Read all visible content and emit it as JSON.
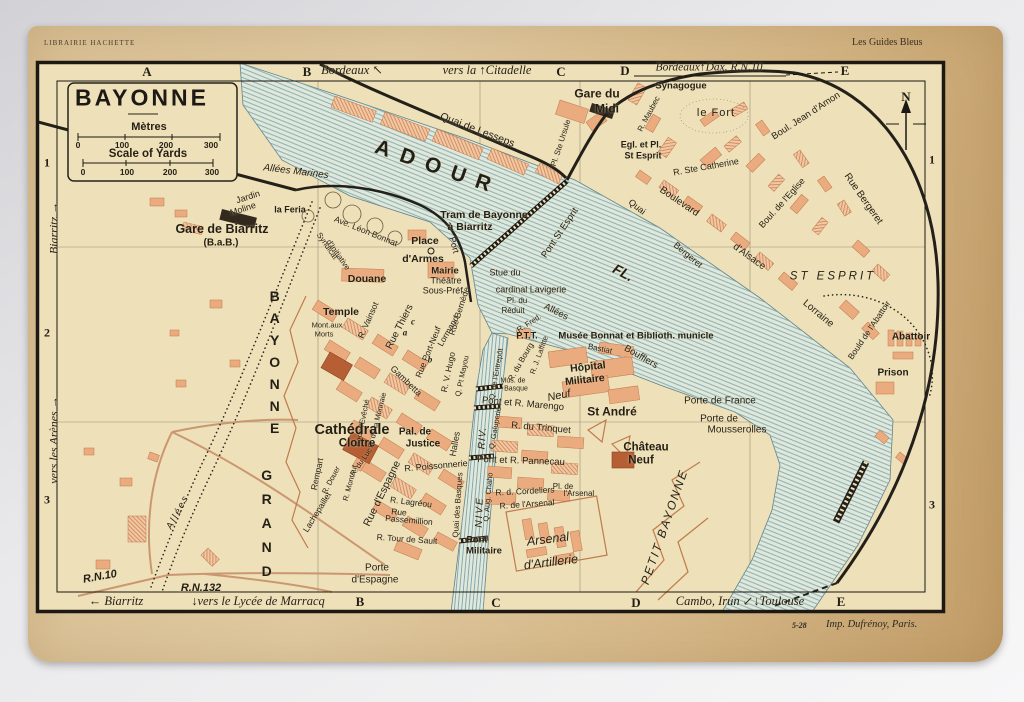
{
  "colors": {
    "paper": "#d9bf93",
    "map_bg": "#eee0b8",
    "ink": "#1c1914",
    "block": "#eaab7e",
    "block_dark": "#b65f35",
    "building_black": "#33291e",
    "river_fill": "#dfe8da",
    "river_line": "#82a8ae",
    "road": "#c8906a"
  },
  "header": {
    "left": "LIBRAIRIE HACHETTE",
    "right": "Les Guides Bleus"
  },
  "imprint": {
    "code": "5-28",
    "text": "Imp. Dufrénoy, Paris."
  },
  "title_block": {
    "title": "BAYONNE",
    "metres": "Mètres",
    "yards": "Scale of Yards"
  },
  "scale": {
    "ticks": [
      {
        "t": "0",
        "x": 78,
        "y": 145,
        "s": 8.5,
        "c": "b"
      },
      {
        "t": "100",
        "x": 122,
        "y": 145,
        "s": 8.5,
        "c": "b"
      },
      {
        "t": "200",
        "x": 166,
        "y": 145,
        "s": 8.5,
        "c": "b"
      },
      {
        "t": "300",
        "x": 211,
        "y": 145,
        "s": 8.5,
        "c": "b"
      },
      {
        "t": "0",
        "x": 83,
        "y": 172,
        "s": 8.5,
        "c": "b"
      },
      {
        "t": "100",
        "x": 127,
        "y": 172,
        "s": 8.5,
        "c": "b"
      },
      {
        "t": "200",
        "x": 170,
        "y": 172,
        "s": 8.5,
        "c": "b"
      },
      {
        "t": "300",
        "x": 212,
        "y": 172,
        "s": 8.5,
        "c": "b"
      }
    ]
  },
  "grid": {
    "letters": [
      {
        "t": "A",
        "x": 147,
        "y": 72,
        "s": 13,
        "c": "serif b"
      },
      {
        "t": "B",
        "x": 307,
        "y": 72,
        "s": 13,
        "c": "serif b"
      },
      {
        "t": "C",
        "x": 561,
        "y": 72,
        "s": 13,
        "c": "serif b"
      },
      {
        "t": "D",
        "x": 625,
        "y": 71,
        "s": 13,
        "c": "serif b"
      },
      {
        "t": "E",
        "x": 845,
        "y": 71,
        "s": 13,
        "c": "serif b"
      },
      {
        "t": "B",
        "x": 360,
        "y": 602,
        "s": 13,
        "c": "serif b"
      },
      {
        "t": "C",
        "x": 496,
        "y": 603,
        "s": 13,
        "c": "serif b"
      },
      {
        "t": "D",
        "x": 636,
        "y": 603,
        "s": 13,
        "c": "serif b"
      },
      {
        "t": "E",
        "x": 841,
        "y": 602,
        "s": 13,
        "c": "serif b"
      }
    ],
    "numbers": [
      {
        "t": "1",
        "x": 47,
        "y": 163,
        "s": 12,
        "c": "serif b"
      },
      {
        "t": "2",
        "x": 47,
        "y": 333,
        "s": 12,
        "c": "serif b"
      },
      {
        "t": "3",
        "x": 47,
        "y": 500,
        "s": 12,
        "c": "serif b"
      },
      {
        "t": "1",
        "x": 932,
        "y": 160,
        "s": 12,
        "c": "serif b"
      },
      {
        "t": "3",
        "x": 932,
        "y": 505,
        "s": 12,
        "c": "serif b"
      }
    ]
  },
  "margins": {
    "notes": [
      {
        "t": "Bordeaux ↖",
        "x": 352,
        "y": 71,
        "s": 12.5,
        "c": "serif i"
      },
      {
        "t": "vers la ↑Citadelle",
        "x": 487,
        "y": 71,
        "s": 12.5,
        "c": "serif i"
      },
      {
        "t": "Bordeaux↑Dax. R.N.10",
        "x": 709,
        "y": 68,
        "s": 11.5,
        "c": "serif i"
      },
      {
        "t": "← Biarritz",
        "x": 116,
        "y": 602,
        "s": 12.5,
        "c": "serif i"
      },
      {
        "t": "↓vers le Lycée de Marracq",
        "x": 258,
        "y": 602,
        "s": 12.5,
        "c": "serif i"
      },
      {
        "t": "Cambo, Irun ↙↓Toulouse",
        "x": 740,
        "y": 602,
        "s": 12.5,
        "c": "serif i"
      },
      {
        "t": "Biarritz →",
        "x": 54,
        "y": 228,
        "s": 12,
        "r": -90,
        "c": "serif i"
      },
      {
        "t": "vers les Arènes →",
        "x": 54,
        "y": 440,
        "s": 12,
        "r": -90,
        "c": "serif i"
      }
    ]
  },
  "map": {
    "labels": [
      {
        "t": "N",
        "x": 906,
        "y": 97,
        "s": 13,
        "c": "serif b",
        "n": "compass-north-label"
      },
      {
        "t": "Gare du",
        "x": 597,
        "y": 94,
        "s": 12,
        "c": "b"
      },
      {
        "t": "Midi",
        "x": 607,
        "y": 109,
        "s": 12,
        "c": "b"
      },
      {
        "t": "Synagogue",
        "x": 681,
        "y": 86,
        "s": 9.5,
        "c": "b"
      },
      {
        "t": "R. Maubec",
        "x": 649,
        "y": 114,
        "s": 8,
        "r": -62
      },
      {
        "t": "le Fort",
        "x": 716,
        "y": 113,
        "s": 11,
        "ls": 1
      },
      {
        "t": "Boul. Jean d'Amon",
        "x": 806,
        "y": 116,
        "s": 9.5,
        "r": -33
      },
      {
        "t": "Rue Bergeret",
        "x": 863,
        "y": 199,
        "s": 10,
        "r": 55
      },
      {
        "t": "R. Ste Catherine",
        "x": 706,
        "y": 167,
        "s": 9,
        "r": -10
      },
      {
        "t": "Boulevard",
        "x": 679,
        "y": 202,
        "s": 10,
        "r": 34
      },
      {
        "t": "d'Alsace",
        "x": 749,
        "y": 257,
        "s": 10,
        "r": 36
      },
      {
        "t": "Lorraine",
        "x": 818,
        "y": 314,
        "s": 10,
        "r": 40
      },
      {
        "t": "Boul. de l'Eglise",
        "x": 782,
        "y": 203,
        "s": 9,
        "r": -48
      },
      {
        "t": "Quai",
        "x": 637,
        "y": 207,
        "s": 9,
        "r": 38
      },
      {
        "t": "Bergeret",
        "x": 688,
        "y": 255,
        "s": 9,
        "r": 40
      },
      {
        "t": "ST ESPRIT",
        "x": 833,
        "y": 277,
        "s": 11.5,
        "c": "i",
        "ls": 3
      },
      {
        "t": "Bould de l'Abattoir",
        "x": 869,
        "y": 330,
        "s": 8.5,
        "r": -56
      },
      {
        "t": "Abattoir",
        "x": 911,
        "y": 337,
        "s": 10,
        "c": "b"
      },
      {
        "t": "Prison",
        "x": 893,
        "y": 373,
        "s": 10,
        "c": "b"
      },
      {
        "t": "Egl. et Pl.",
        "x": 641,
        "y": 145,
        "s": 9,
        "c": "b"
      },
      {
        "t": "St Esprit",
        "x": 643,
        "y": 156,
        "s": 9,
        "c": "b"
      },
      {
        "t": "Quai de Lesseps",
        "x": 477,
        "y": 131,
        "s": 10.5,
        "r": 21
      },
      {
        "t": "Pl. Ste Ursule",
        "x": 561,
        "y": 143,
        "s": 8,
        "r": -72
      },
      {
        "t": "ADOUR",
        "x": 438,
        "y": 168,
        "s": 21,
        "r": 19,
        "c": "b",
        "ls": 11,
        "n": "river-adour-label"
      },
      {
        "t": "FL.",
        "x": 623,
        "y": 273,
        "s": 14,
        "r": 28,
        "c": "b i",
        "n": "river-adour-label"
      },
      {
        "t": "Pont St Esprit",
        "x": 560,
        "y": 233,
        "s": 9.5,
        "r": -56
      },
      {
        "t": "NIVE",
        "x": 480,
        "y": 512,
        "s": 10,
        "r": -88,
        "c": "i",
        "ls": 2,
        "n": "river-nive-label"
      },
      {
        "t": "RIV.",
        "x": 483,
        "y": 438,
        "s": 10,
        "r": -86,
        "c": "i",
        "ls": 1,
        "n": "river-nive-label"
      },
      {
        "t": "Allées Marines",
        "x": 296,
        "y": 172,
        "s": 10,
        "r": 7,
        "c": "i"
      },
      {
        "t": "Jardin",
        "x": 248,
        "y": 197,
        "s": 9,
        "r": -18
      },
      {
        "t": "Moline",
        "x": 243,
        "y": 209,
        "s": 9,
        "r": -18
      },
      {
        "t": "la Feria",
        "x": 290,
        "y": 210,
        "s": 9,
        "c": "b"
      },
      {
        "t": "Gare de Biarritz",
        "x": 222,
        "y": 230,
        "s": 12.5,
        "c": "b"
      },
      {
        "t": "(B.a.B.)",
        "x": 221,
        "y": 243,
        "s": 10,
        "c": "b"
      },
      {
        "t": "Tram de Bayonne",
        "x": 484,
        "y": 216,
        "s": 10.5,
        "c": "b"
      },
      {
        "t": "à Biarritz",
        "x": 470,
        "y": 228,
        "s": 10.5,
        "c": "b"
      },
      {
        "t": "Ave. Léon Bonnat",
        "x": 366,
        "y": 231,
        "s": 8.5,
        "r": 22
      },
      {
        "t": "Syndicat",
        "x": 327,
        "y": 246,
        "s": 8,
        "r": 55
      },
      {
        "t": "d'Initiative",
        "x": 338,
        "y": 255,
        "s": 8,
        "r": 55
      },
      {
        "t": "Port",
        "x": 454,
        "y": 245,
        "s": 9,
        "r": 75
      },
      {
        "t": "Place",
        "x": 425,
        "y": 242,
        "s": 10.5,
        "c": "b"
      },
      {
        "t": "d'Armes",
        "x": 423,
        "y": 260,
        "s": 10.5,
        "c": "b"
      },
      {
        "t": "Mairie",
        "x": 445,
        "y": 271,
        "s": 9.5,
        "c": "b"
      },
      {
        "t": "Théâtre",
        "x": 446,
        "y": 281,
        "s": 9
      },
      {
        "t": "Sous-Préf.",
        "x": 444,
        "y": 291,
        "s": 9
      },
      {
        "t": "Douane",
        "x": 367,
        "y": 280,
        "s": 10.5,
        "c": "b"
      },
      {
        "t": "Temple",
        "x": 341,
        "y": 313,
        "s": 10.5,
        "c": "b"
      },
      {
        "t": "Mont.aux",
        "x": 327,
        "y": 325,
        "s": 7.5
      },
      {
        "t": "Morts",
        "x": 324,
        "y": 334,
        "s": 7.5
      },
      {
        "t": "Stue du",
        "x": 505,
        "y": 273,
        "s": 9
      },
      {
        "t": "cardinal Lavigerie",
        "x": 531,
        "y": 290,
        "s": 9
      },
      {
        "t": "Pl. du",
        "x": 517,
        "y": 301,
        "s": 8
      },
      {
        "t": "Réduit",
        "x": 513,
        "y": 311,
        "s": 8
      },
      {
        "t": "Allées",
        "x": 556,
        "y": 312,
        "s": 9.5,
        "r": 27
      },
      {
        "t": "Boufflers",
        "x": 641,
        "y": 357,
        "s": 9.5,
        "r": 30
      },
      {
        "t": "P.T.T.",
        "x": 527,
        "y": 336,
        "s": 9,
        "c": "b"
      },
      {
        "t": "Musée Bonnat et Biblioth. municle",
        "x": 636,
        "y": 336,
        "s": 9.5,
        "c": "b"
      },
      {
        "t": "R. Fred.",
        "x": 529,
        "y": 323,
        "s": 7.5,
        "r": -33
      },
      {
        "t": "Bastiat",
        "x": 600,
        "y": 349,
        "s": 8,
        "r": 12
      },
      {
        "t": "R. du Bourg",
        "x": 521,
        "y": 362,
        "s": 8,
        "r": -60
      },
      {
        "t": "Neuf",
        "x": 559,
        "y": 396,
        "s": 11,
        "c": "i",
        "r": -12
      },
      {
        "t": "R. J. Laffitte",
        "x": 539,
        "y": 355,
        "s": 7.5,
        "r": -70
      },
      {
        "t": "Q. de l'Entrepôt",
        "x": 496,
        "y": 374,
        "s": 7.5,
        "r": -80
      },
      {
        "t": "Q. Galuperie",
        "x": 495,
        "y": 428,
        "s": 7.5,
        "r": -80
      },
      {
        "t": "Q. Aug. Chaho",
        "x": 488,
        "y": 497,
        "s": 7.5,
        "r": -85
      },
      {
        "t": "Quai des Basques",
        "x": 458,
        "y": 505,
        "s": 8,
        "r": -86
      },
      {
        "t": "Hôpital",
        "x": 588,
        "y": 368,
        "s": 10.5,
        "c": "b",
        "r": -6
      },
      {
        "t": "Militaire",
        "x": 585,
        "y": 381,
        "s": 10.5,
        "c": "b",
        "r": -6
      },
      {
        "t": "Mus. de",
        "x": 513,
        "y": 382,
        "s": 7
      },
      {
        "t": "Basque",
        "x": 516,
        "y": 390,
        "s": 7
      },
      {
        "t": "Pont et R. Marengo",
        "x": 523,
        "y": 404,
        "s": 9.5,
        "r": 5
      },
      {
        "t": "St André",
        "x": 612,
        "y": 412,
        "s": 12,
        "c": "b"
      },
      {
        "t": "R. du Trinquet",
        "x": 541,
        "y": 428,
        "s": 9.5,
        "r": 5
      },
      {
        "t": "Pont et R. Pannecau",
        "x": 521,
        "y": 461,
        "s": 9.5,
        "r": 2
      },
      {
        "t": "Halles",
        "x": 455,
        "y": 444,
        "s": 9,
        "r": -80
      },
      {
        "t": "R. Poissonnerie",
        "x": 436,
        "y": 466,
        "s": 9,
        "r": -5
      },
      {
        "t": "Château",
        "x": 646,
        "y": 448,
        "s": 11.5,
        "c": "b"
      },
      {
        "t": "Neuf",
        "x": 641,
        "y": 461,
        "s": 11.5,
        "c": "b"
      },
      {
        "t": "Porte de France",
        "x": 720,
        "y": 401,
        "s": 10
      },
      {
        "t": "Porte de",
        "x": 719,
        "y": 419,
        "s": 10
      },
      {
        "t": "Mousserolles",
        "x": 737,
        "y": 430,
        "s": 10
      },
      {
        "t": "R. d. Cordeliers",
        "x": 525,
        "y": 491,
        "s": 8.5,
        "r": -3
      },
      {
        "t": "Pl. de",
        "x": 563,
        "y": 487,
        "s": 8
      },
      {
        "t": "l'Arsenal",
        "x": 579,
        "y": 494,
        "s": 8
      },
      {
        "t": "R. de l'Arsenal",
        "x": 527,
        "y": 504,
        "s": 8.5,
        "r": -4
      },
      {
        "t": "Arsenal",
        "x": 548,
        "y": 540,
        "s": 12.5,
        "c": "i",
        "r": -7
      },
      {
        "t": "d'Artillerie",
        "x": 551,
        "y": 563,
        "s": 12.5,
        "c": "i",
        "r": -7
      },
      {
        "t": "Pont",
        "x": 477,
        "y": 540,
        "s": 9.5,
        "c": "b"
      },
      {
        "t": "Militaire",
        "x": 484,
        "y": 551,
        "s": 9.5,
        "c": "b"
      },
      {
        "t": "PETIT BAYONNE",
        "x": 665,
        "y": 527,
        "s": 12,
        "c": "i",
        "r": -71,
        "ls": 2,
        "n": "district-label"
      },
      {
        "t": "GRAND",
        "x": 266,
        "y": 527,
        "s": 14,
        "c": "b",
        "st": 1,
        "ls": 8,
        "n": "district-label"
      },
      {
        "t": "BAYONNE",
        "x": 274,
        "y": 365,
        "s": 14,
        "c": "b",
        "st": 1,
        "ls": 6,
        "n": "district-label"
      },
      {
        "t": "Rue Thiers",
        "x": 400,
        "y": 327,
        "s": 10,
        "r": -63
      },
      {
        "t": "R. Vainsot",
        "x": 368,
        "y": 320,
        "s": 8.5,
        "r": -66
      },
      {
        "t": "Rue Bernède",
        "x": 459,
        "y": 311,
        "s": 8.5,
        "r": -72
      },
      {
        "t": "Lormand",
        "x": 448,
        "y": 331,
        "s": 8.5,
        "r": -60
      },
      {
        "t": "Rue Port-Neuf",
        "x": 428,
        "y": 352,
        "s": 8.5,
        "r": -68
      },
      {
        "t": "R. V. Hugo",
        "x": 448,
        "y": 372,
        "s": 8.5,
        "r": -78
      },
      {
        "t": "Q. Pt Mayou",
        "x": 462,
        "y": 376,
        "s": 7.5,
        "r": -78
      },
      {
        "t": "Gambetta",
        "x": 406,
        "y": 381,
        "s": 9,
        "r": 44
      },
      {
        "t": "R. de la Monnaie",
        "x": 377,
        "y": 420,
        "s": 7.5,
        "r": -76
      },
      {
        "t": "R. de l'Evêché",
        "x": 362,
        "y": 423,
        "s": 7.5,
        "r": -78
      },
      {
        "t": "a",
        "x": 405,
        "y": 333,
        "s": 9,
        "c": "serif b i",
        "n": "reference-letter"
      },
      {
        "t": "b",
        "x": 430,
        "y": 360,
        "s": 9,
        "c": "serif b i",
        "n": "reference-letter"
      },
      {
        "t": "c",
        "x": 413,
        "y": 322,
        "s": 9,
        "c": "serif b i",
        "n": "reference-letter"
      },
      {
        "t": "Cathédrale",
        "x": 352,
        "y": 431,
        "s": 14.5,
        "c": "b"
      },
      {
        "t": "Cloître",
        "x": 357,
        "y": 444,
        "s": 11.5,
        "c": "b"
      },
      {
        "t": "Pal. de",
        "x": 415,
        "y": 432,
        "s": 10,
        "c": "b"
      },
      {
        "t": "Justice",
        "x": 423,
        "y": 444,
        "s": 10,
        "c": "b"
      },
      {
        "t": "Rempart",
        "x": 317,
        "y": 474,
        "s": 8.5,
        "r": -78
      },
      {
        "t": "Lachepaillet",
        "x": 317,
        "y": 512,
        "s": 8.5,
        "r": -58
      },
      {
        "t": "R. Douer",
        "x": 331,
        "y": 480,
        "s": 7.5,
        "r": -62
      },
      {
        "t": "R. Montaut",
        "x": 350,
        "y": 483,
        "s": 7.5,
        "r": -75
      },
      {
        "t": "R. du Luc",
        "x": 361,
        "y": 462,
        "s": 7.5,
        "r": -55
      },
      {
        "t": "Rue d'Espagne",
        "x": 383,
        "y": 494,
        "s": 10.5,
        "r": -64
      },
      {
        "t": "R. Lagréou",
        "x": 411,
        "y": 502,
        "s": 8.5,
        "r": 7
      },
      {
        "t": "Rue",
        "x": 399,
        "y": 512,
        "s": 8.5,
        "r": 5
      },
      {
        "t": "Passemillion",
        "x": 409,
        "y": 520,
        "s": 8.5,
        "r": 5
      },
      {
        "t": "R. Tour de Sault",
        "x": 407,
        "y": 539,
        "s": 8.5,
        "r": 4
      },
      {
        "t": "Porte",
        "x": 377,
        "y": 568,
        "s": 10
      },
      {
        "t": "d'Espagne",
        "x": 375,
        "y": 580,
        "s": 10
      },
      {
        "t": "Allées",
        "x": 178,
        "y": 512,
        "s": 9.5,
        "c": "i",
        "r": -62,
        "ls": 2
      },
      {
        "t": "R.N.10",
        "x": 100,
        "y": 577,
        "s": 11,
        "c": "b i",
        "r": -10,
        "n": "road-number"
      },
      {
        "t": "R.N.132",
        "x": 201,
        "y": 588,
        "s": 11,
        "c": "b i",
        "n": "road-number"
      }
    ]
  }
}
